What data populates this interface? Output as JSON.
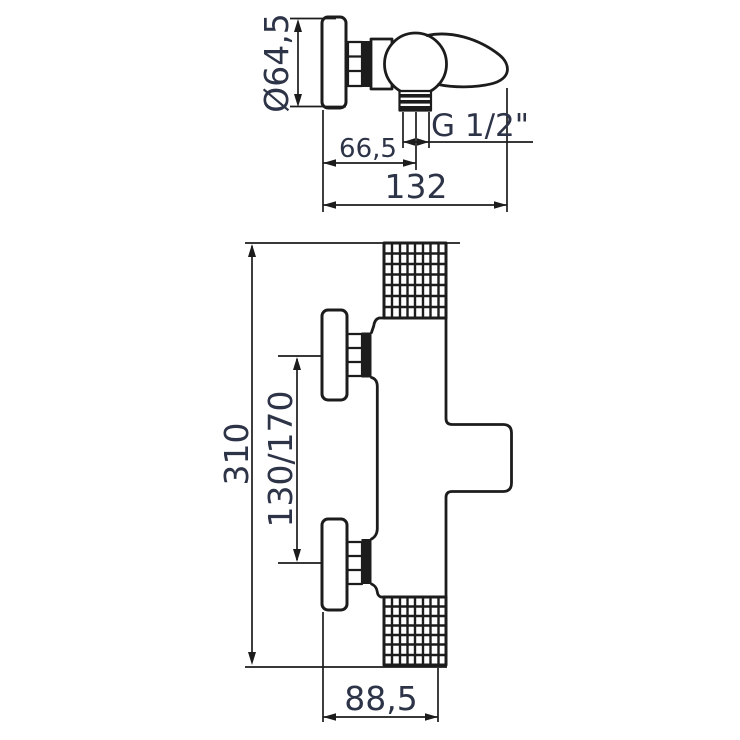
{
  "colors": {
    "background": "#ffffff",
    "line": "#1c1c1c",
    "text": "#2e3447"
  },
  "drawing": {
    "kind": "shower-mixer-technical-drawing",
    "views": [
      "side-view-wall-mounted-mixer",
      "front-view-thermostatic-mixer"
    ]
  },
  "dimensions": {
    "diameter": "Ø64,5",
    "wall_to_outlet": "66,5",
    "depth": "132",
    "thread": "G 1/2\"",
    "height": "310",
    "spacing": "130/170",
    "width": "88,5"
  }
}
